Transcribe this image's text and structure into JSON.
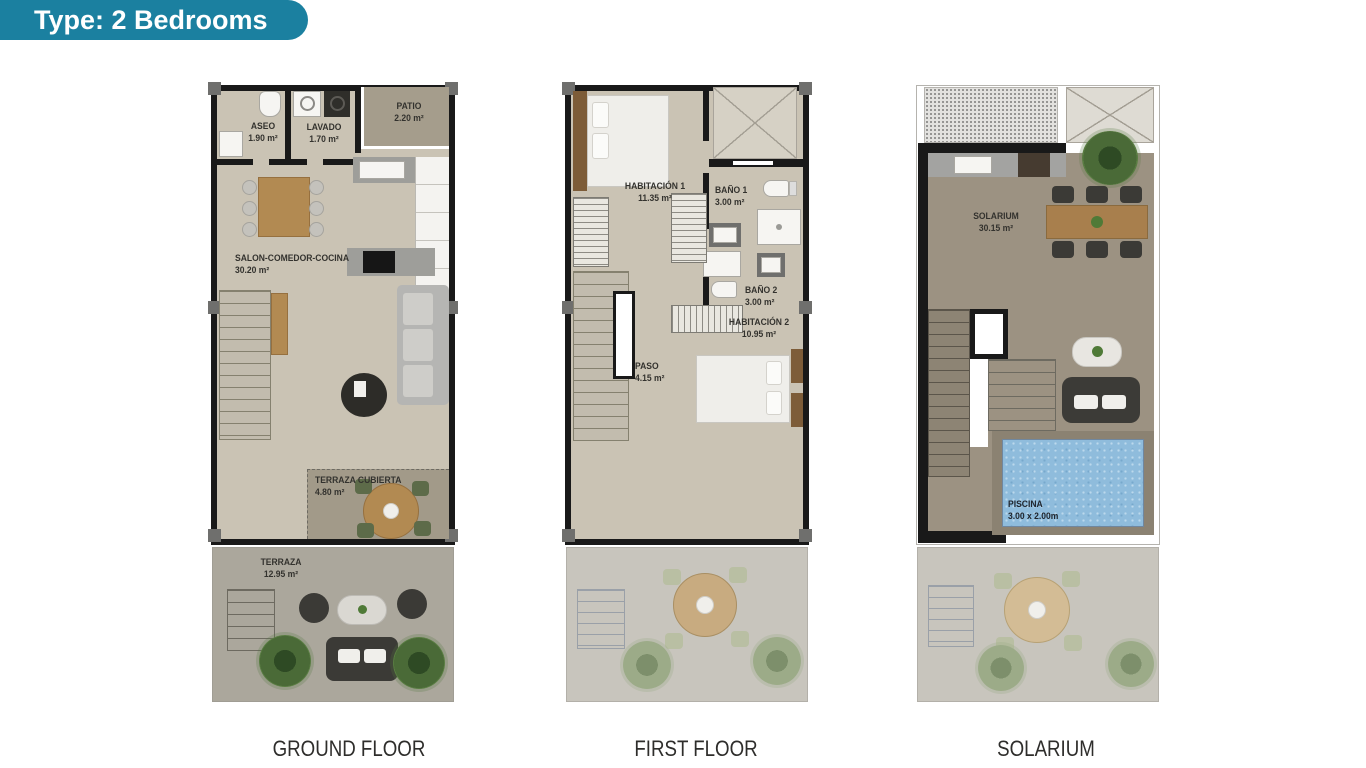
{
  "badge": {
    "label": "Type: 2 Bedrooms"
  },
  "plans": [
    {
      "id": "ground-floor",
      "caption": "GROUND FLOOR",
      "rooms": [
        {
          "name": "ASEO",
          "area": "1.90 m²"
        },
        {
          "name": "LAVADO",
          "area": "1.70 m²"
        },
        {
          "name": "PATIO",
          "area": "2.20 m²"
        },
        {
          "name": "SALON-COMEDOR-COCINA",
          "area": "30.20 m²"
        },
        {
          "name": "TERRAZA CUBIERTA",
          "area": "4.80 m²"
        },
        {
          "name": "TERRAZA",
          "area": "12.95 m²"
        }
      ]
    },
    {
      "id": "first-floor",
      "caption": "FIRST FLOOR",
      "rooms": [
        {
          "name": "HABITACIÓN 1",
          "area": "11.35 m²"
        },
        {
          "name": "BAÑO 1",
          "area": "3.00 m²"
        },
        {
          "name": "BAÑO 2",
          "area": "3.00 m²"
        },
        {
          "name": "HABITACIÓN 2",
          "area": "10.95 m²"
        },
        {
          "name": "PASO",
          "area": "4.15 m²"
        }
      ]
    },
    {
      "id": "solarium",
      "caption": "SOLARIUM",
      "rooms": [
        {
          "name": "SOLARIUM",
          "area": "30.15 m²"
        },
        {
          "name": "PISCINA",
          "area": "3.00 x 2.00m"
        }
      ]
    }
  ],
  "colors": {
    "badge_teal": "#1b80a0",
    "wall_black": "#191919",
    "interior_floor": "#cac3b4",
    "terrace_taupe": "#a39b8a",
    "pool_blue": "#8fbcdc"
  }
}
